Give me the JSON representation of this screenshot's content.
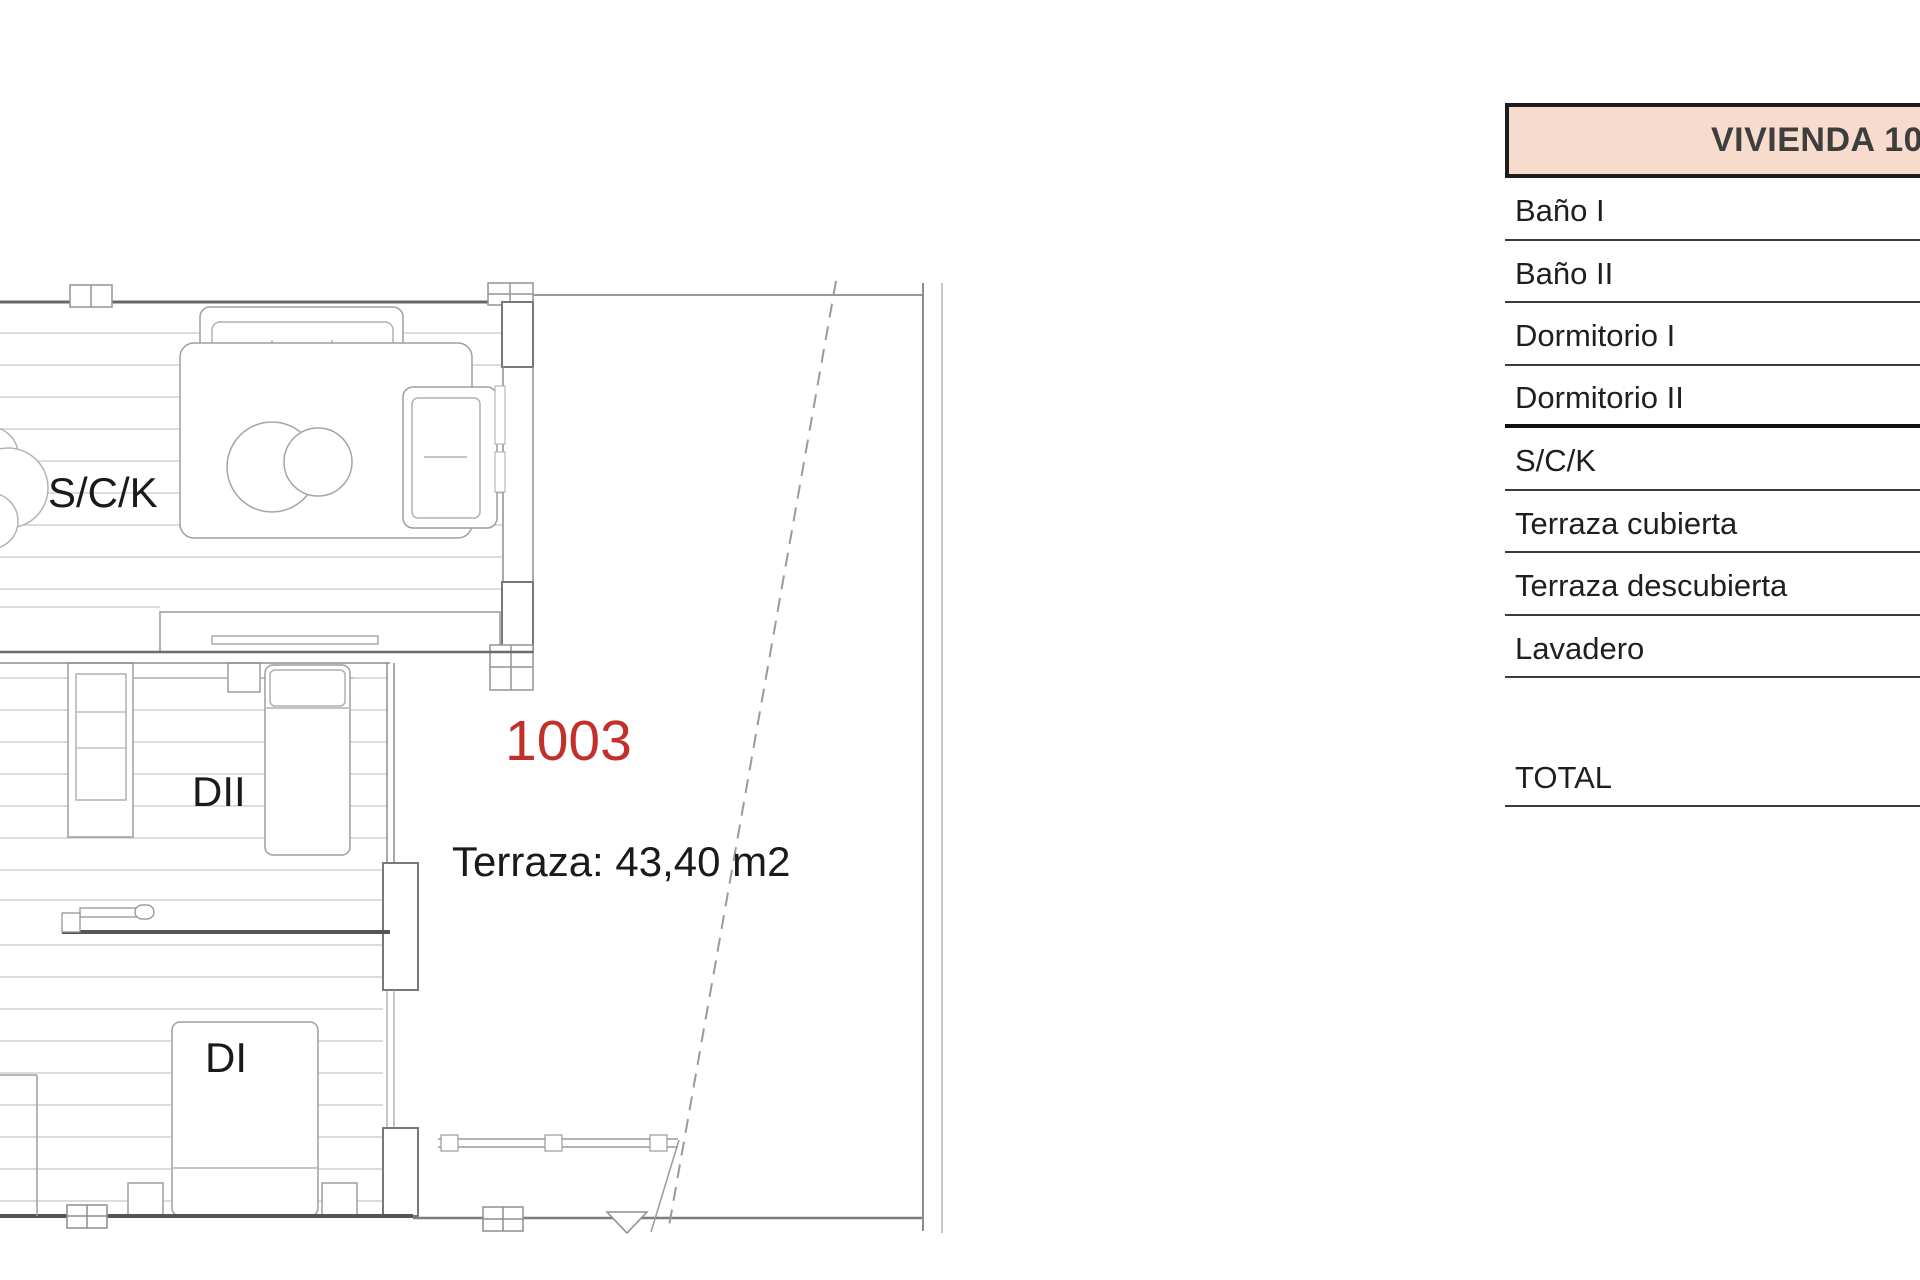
{
  "plan": {
    "labels": {
      "living": "S/C/K",
      "bedroom2": "DII",
      "bedroom1": "DI",
      "unit_number": "1003",
      "terrace_area": "Terraza: 43,40 m2"
    },
    "colors": {
      "unit_number_red": "#c2302c"
    }
  },
  "table": {
    "header": "VIVIENDA 10",
    "header_bg": "#f7dbcd",
    "rows": [
      {
        "label": "Baño I"
      },
      {
        "label": "Baño II"
      },
      {
        "label": "Dormitorio I"
      },
      {
        "label": "Dormitorio II"
      },
      {
        "label": "S/C/K"
      },
      {
        "label": "Terraza cubierta"
      },
      {
        "label": "Terraza descubierta"
      },
      {
        "label": "Lavadero"
      }
    ],
    "total_label": "TOTAL"
  }
}
